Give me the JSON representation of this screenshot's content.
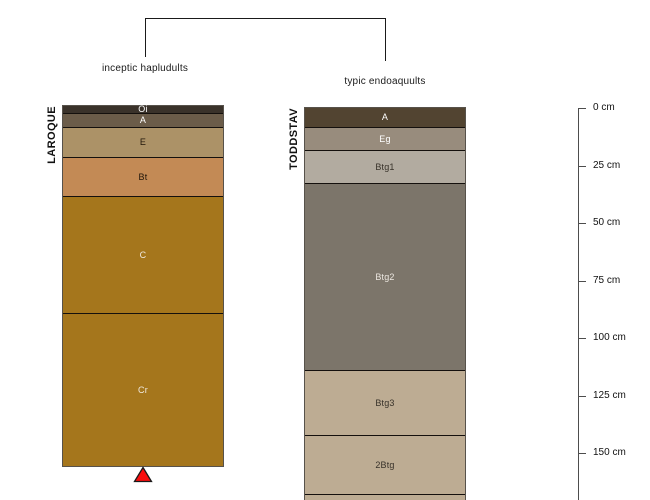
{
  "figure": {
    "type": "soil-profile-sketch",
    "background": "#ffffff",
    "grouping_bracket": {
      "left_classification": "inceptic hapludults",
      "right_classification": "typic endoaquults"
    },
    "depth_axis": {
      "unit": "cm",
      "tick_labels": [
        "0 cm",
        "25 cm",
        "50 cm",
        "75 cm",
        "100 cm",
        "125 cm",
        "150 cm"
      ],
      "tick_values_cm": [
        0,
        25,
        50,
        75,
        100,
        125,
        150
      ],
      "line_color": "#4d4d4d",
      "x_px": 578,
      "top_px": 108,
      "px_per_tick": 57.5,
      "bottom_px": 500
    },
    "profiles": [
      {
        "name": "LAROQUE",
        "classification": "inceptic hapludults",
        "x_px": 63,
        "width_px": 160,
        "top_px": 106,
        "horizons": [
          {
            "label": "Oi",
            "depth_cm": "0-2",
            "top_px": 106,
            "height_px": 7,
            "color": "#3a322a",
            "label_color": "#ffffff"
          },
          {
            "label": "A",
            "depth_cm": "2-8",
            "top_px": 113,
            "height_px": 14,
            "color": "#6b5c49",
            "label_color": "#ffffff"
          },
          {
            "label": "E",
            "depth_cm": "8-22",
            "top_px": 127,
            "height_px": 30,
            "color": "#ac9267",
            "label_color": "#20160a"
          },
          {
            "label": "Bt",
            "depth_cm": "22-38",
            "top_px": 157,
            "height_px": 39,
            "color": "#c38a55",
            "label_color": "#20160a"
          },
          {
            "label": "C",
            "depth_cm": "38-89",
            "top_px": 196,
            "height_px": 117,
            "color": "#a5761c",
            "label_color": "#f0e9df"
          },
          {
            "label": "Cr",
            "depth_cm": "89-156",
            "top_px": 313,
            "height_px": 153,
            "color": "#a5761c",
            "label_color": "#f0e9df"
          }
        ],
        "bottom_marker": {
          "shape": "triangle-up",
          "fill": "#fa0e0e",
          "outline": "#1a1a1a"
        }
      },
      {
        "name": "TODDSTAV",
        "classification": "typic endoaquults",
        "x_px": 305,
        "width_px": 160,
        "top_px": 108,
        "horizons": [
          {
            "label": "A",
            "depth_cm": "0-8",
            "top_px": 108,
            "height_px": 19,
            "color": "#524431",
            "label_color": "#ffffff"
          },
          {
            "label": "Eg",
            "depth_cm": "8-18",
            "top_px": 127,
            "height_px": 23,
            "color": "#988c7d",
            "label_color": "#ffffff"
          },
          {
            "label": "Btg1",
            "depth_cm": "18-33",
            "top_px": 150,
            "height_px": 33,
            "color": "#b2aba0",
            "label_color": "#38322a"
          },
          {
            "label": "Btg2",
            "depth_cm": "33-114",
            "top_px": 183,
            "height_px": 187,
            "color": "#7c756a",
            "label_color": "#ece7e0"
          },
          {
            "label": "Btg3",
            "depth_cm": "114-142",
            "top_px": 370,
            "height_px": 65,
            "color": "#bdac93",
            "label_color": "#38322a"
          },
          {
            "label": "2Btg",
            "depth_cm": "142-168",
            "top_px": 435,
            "height_px": 59,
            "color": "#bdac93",
            "label_color": "#38322a"
          },
          {
            "label": "",
            "depth_cm": "168+",
            "top_px": 494,
            "height_px": 6,
            "color": "#bdac93",
            "label_color": "#38322a"
          }
        ],
        "bottom_marker": null
      }
    ]
  }
}
